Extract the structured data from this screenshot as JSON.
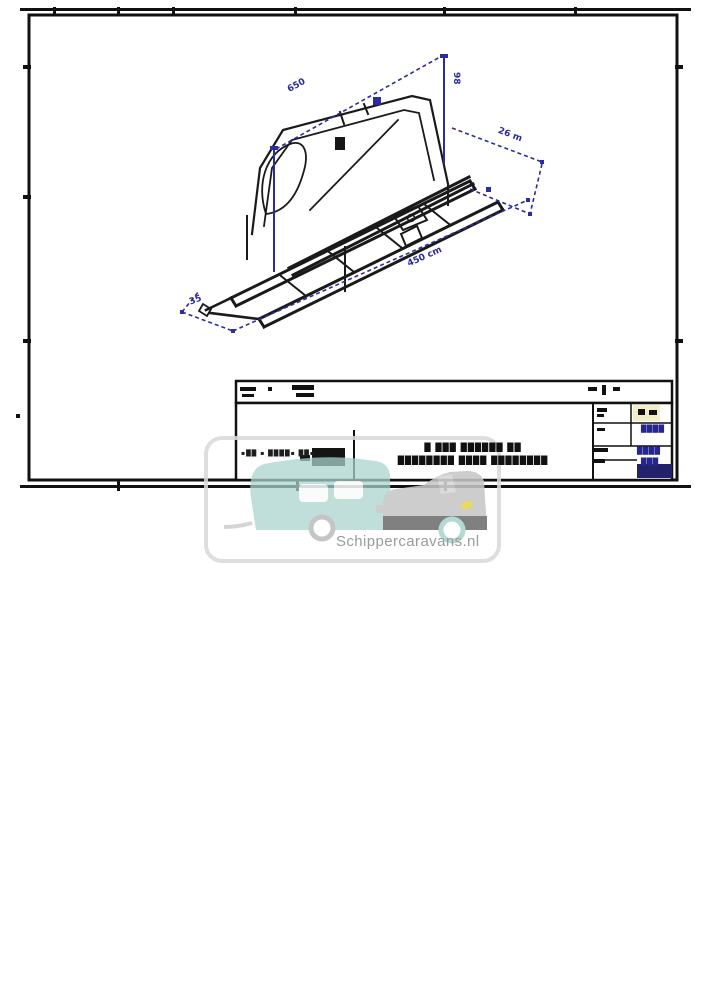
{
  "watermark": {
    "text": "Schippercaravans.nl",
    "teal": "#a9d3ce",
    "gray": "#c6c6c6",
    "dark_gray": "#6e6e6e",
    "yellow": "#e8d44c",
    "border": "#dadada"
  },
  "dimensions": {
    "top": "650",
    "height": "98",
    "right": "26 m",
    "length": "450 cm",
    "left": "35",
    "color": "#2a2a9e"
  },
  "title_block": {
    "company": "▪██ ▪ ████▪ ██▪",
    "title_line1": "█ ███ ██████ ██",
    "title_line2": "████████ ████ ████████",
    "field1": "████",
    "field2": "████",
    "field3": "███",
    "value_color": "#26268e"
  }
}
